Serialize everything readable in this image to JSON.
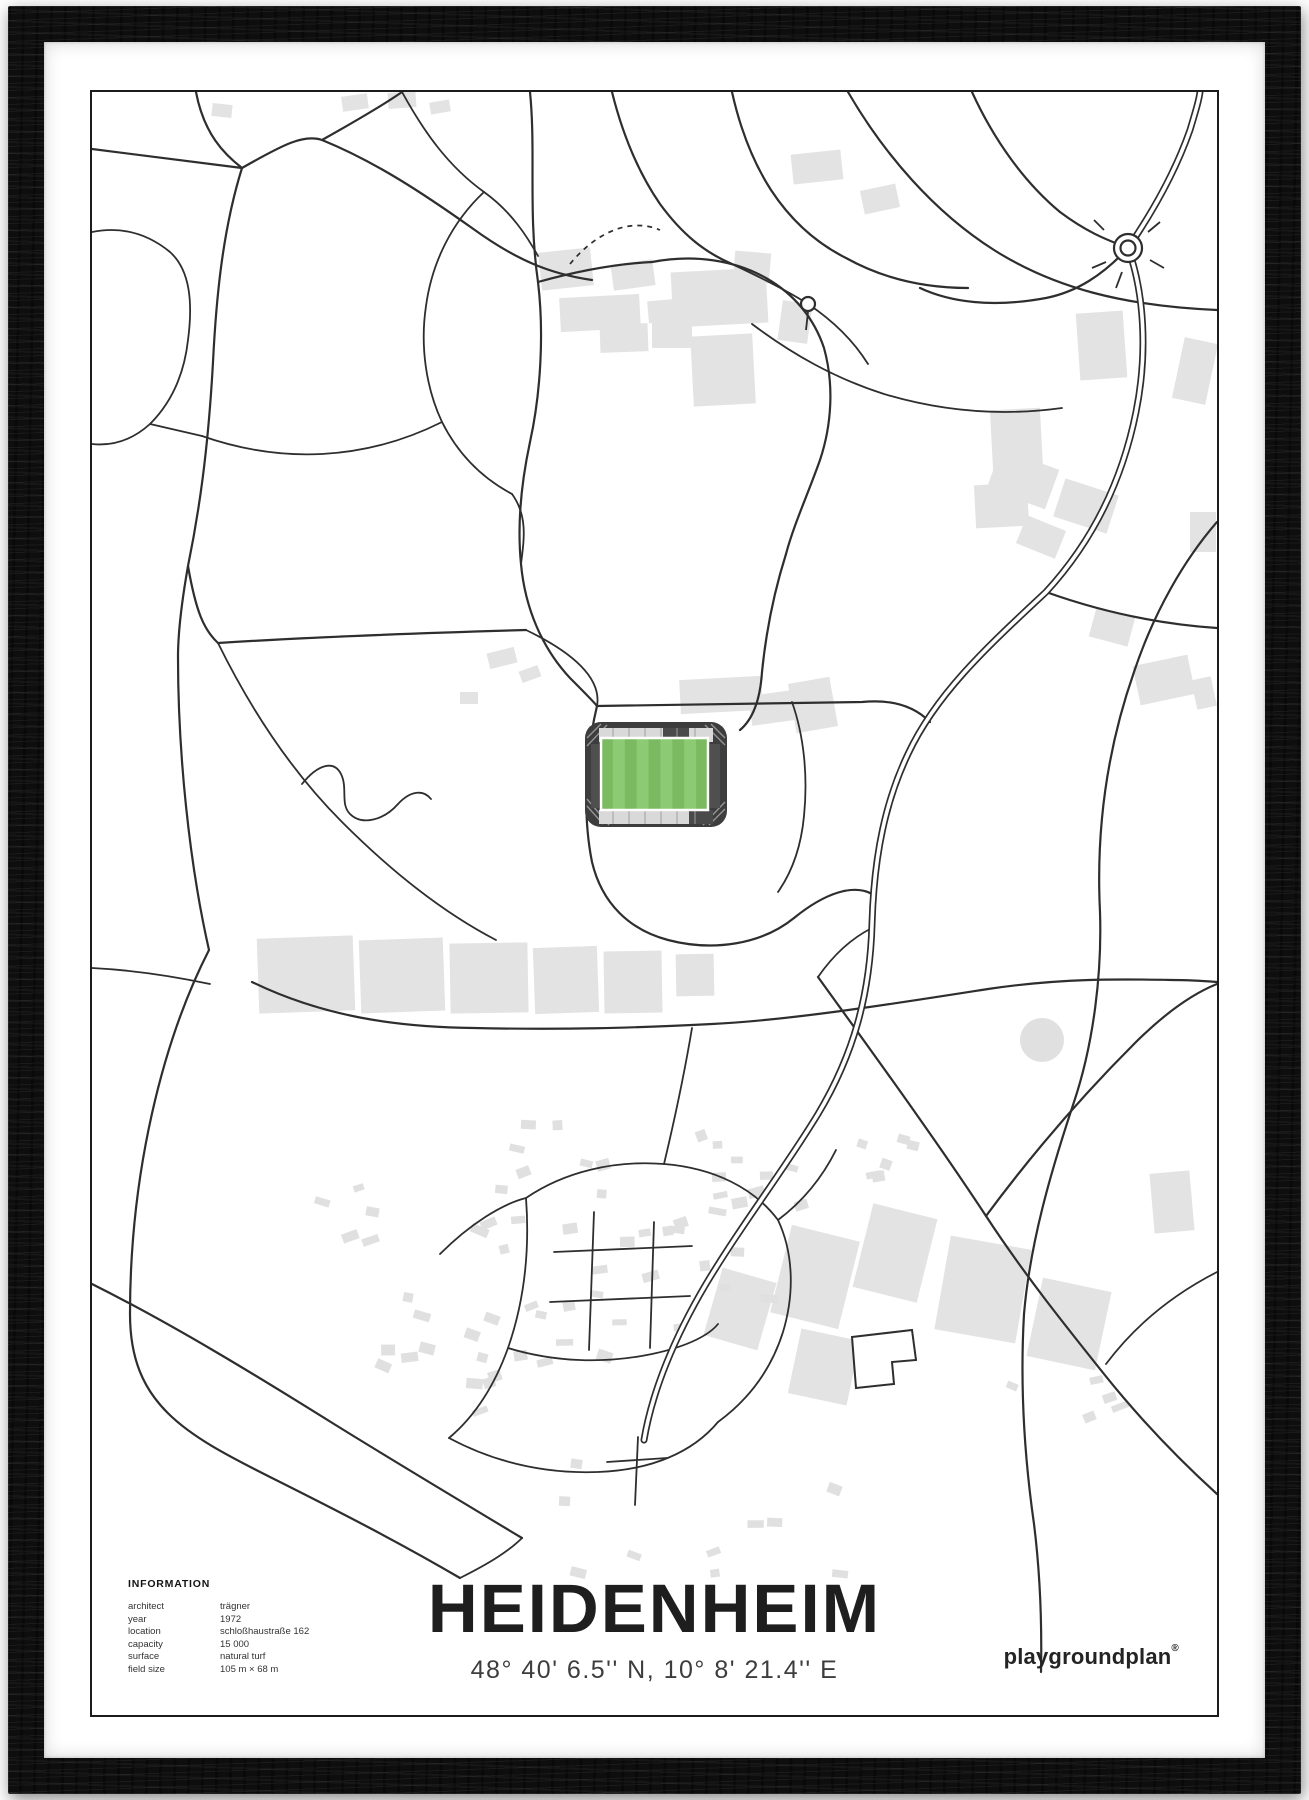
{
  "poster": {
    "title": "HEIDENHEIM",
    "coordinates": "48° 40' 6.5'' N, 10° 8' 21.4'' E",
    "brand": "playgroundplan",
    "brand_mark": "®",
    "info": {
      "heading": "INFORMATION",
      "rows": [
        {
          "label": "architect",
          "value": "trägner"
        },
        {
          "label": "year",
          "value": "1972"
        },
        {
          "label": "location",
          "value": "schloßhaustraße 162"
        },
        {
          "label": "capacity",
          "value": "15 000"
        },
        {
          "label": "surface",
          "value": "natural turf"
        },
        {
          "label": "field size",
          "value": "105 m × 68 m"
        }
      ]
    }
  },
  "map": {
    "features": [
      "roads",
      "buildings",
      "stadium",
      "roundabout",
      "pond",
      "residential-area"
    ],
    "colors": {
      "road": "#2e2e2e",
      "building": "#e3e3e3",
      "pitch": "#7cba62",
      "pitch_stripe": "#8ccb74",
      "stand": "#d9d9d9",
      "structure": "#3d3d3d",
      "frame": "#0e0e0e"
    }
  }
}
